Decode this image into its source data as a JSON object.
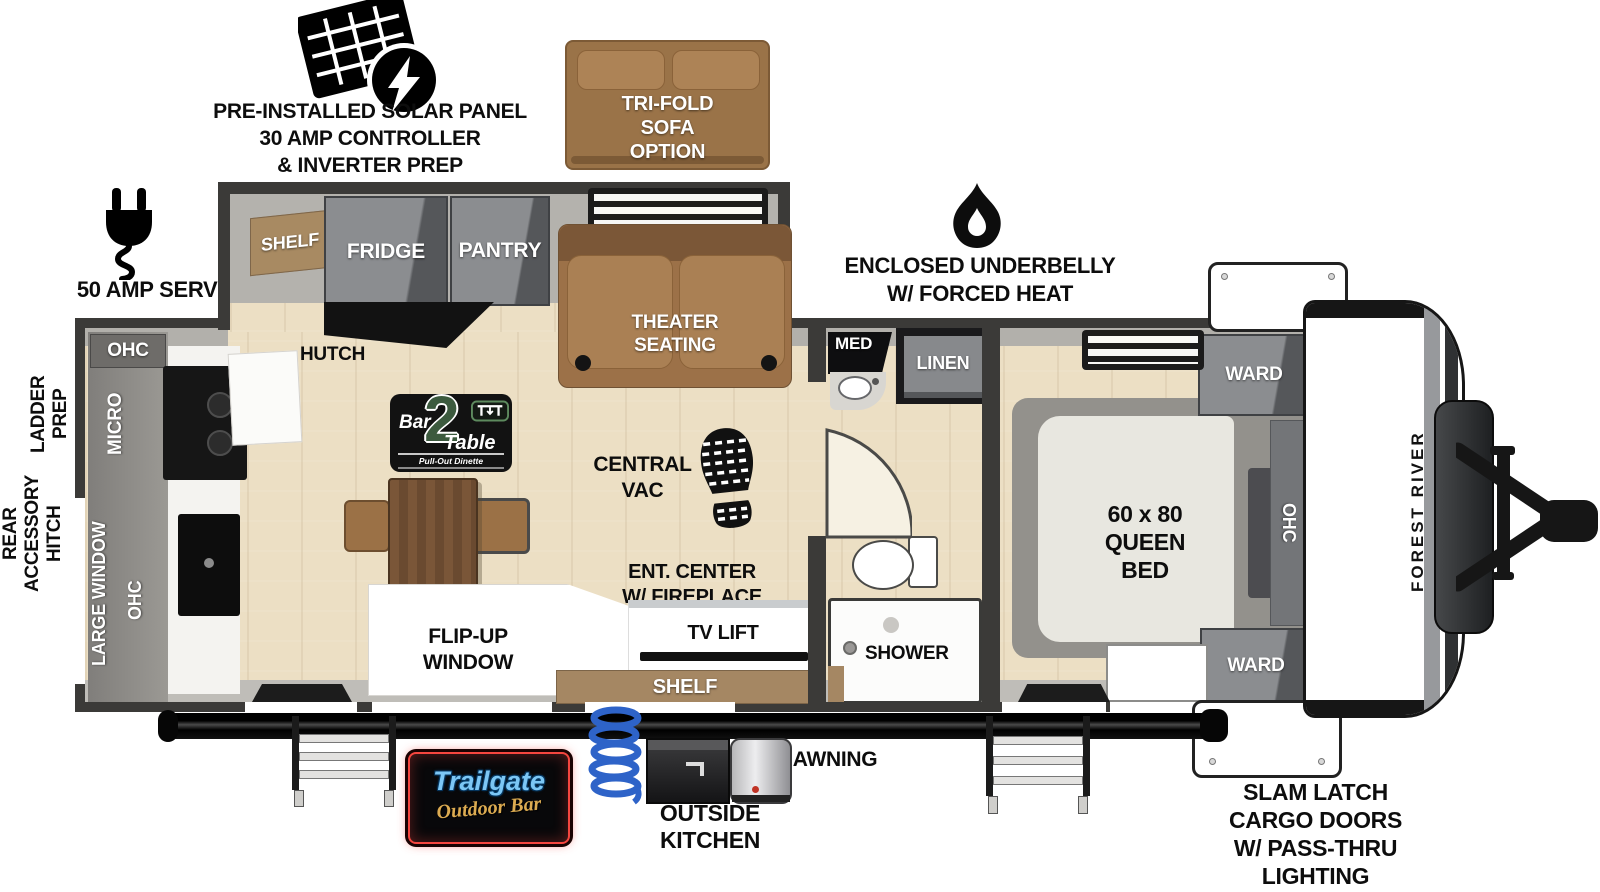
{
  "colors": {
    "wall": "#3b3a38",
    "floor_wood": "#ecdfc4",
    "cabinet_gray": "#87898c",
    "sofa_brown": "#9c7148",
    "shelf_brown": "#a58763",
    "logo_green": "#3c5a3e",
    "neon_red": "#f5463f",
    "neon_blue": "#7cc7f5",
    "gold": "#dcab51",
    "hose_blue": "#2e63c8"
  },
  "annotations": {
    "solar": [
      "PRE-INSTALLED SOLAR PANEL",
      "30 AMP CONTROLLER",
      "& INVERTER PREP"
    ],
    "amp_service": "50 AMP SERVICE",
    "ladder_prep": [
      "LADDER",
      "PREP"
    ],
    "rear_hitch": [
      "REAR",
      "ACCESSORY",
      "HITCH"
    ],
    "underbelly": [
      "ENCLOSED UNDERBELLY",
      "W/ FORCED HEAT"
    ],
    "awning": "AWNING",
    "outside_kitchen": [
      "OUTSIDE",
      "KITCHEN"
    ],
    "slam_latch": [
      "SLAM LATCH",
      "CARGO DOORS",
      "W/ PASS-THRU",
      "LIGHTING"
    ],
    "trifold_sofa": [
      "TRI-FOLD",
      "SOFA",
      "OPTION"
    ],
    "brand": "FOREST RIVER"
  },
  "living": {
    "shelf": "SHELF",
    "fridge": "FRIDGE",
    "pantry": "PANTRY",
    "hutch": "HUTCH",
    "theater_seating": [
      "THEATER",
      "SEATING"
    ],
    "central_vac": [
      "CENTRAL",
      "VAC"
    ],
    "ent_center": [
      "ENT. CENTER",
      "W/ FIREPLACE"
    ],
    "tv_lift": "TV LIFT",
    "shelf_bottom": "SHELF",
    "flip_up_window": [
      "FLIP-UP",
      "WINDOW"
    ]
  },
  "kitchen": {
    "ohc_top": "OHC",
    "micro": "MICRO",
    "large_window": "LARGE WINDOW",
    "ohc_side": "OHC"
  },
  "bath": {
    "med": "MED",
    "linen": "LINEN",
    "shower": "SHOWER"
  },
  "bedroom": {
    "bed": [
      "60 x 80",
      "QUEEN",
      "BED"
    ],
    "ward_top": "WARD",
    "ward_bottom": "WARD",
    "ohc": "OHC"
  },
  "logos": {
    "bar2table": {
      "bar": "Bar",
      "two": "2",
      "table": "Table",
      "tagline": "Pull-Out Dinette"
    },
    "trailgate": {
      "name": "Trailgate",
      "tagline": "Outdoor Bar"
    }
  }
}
